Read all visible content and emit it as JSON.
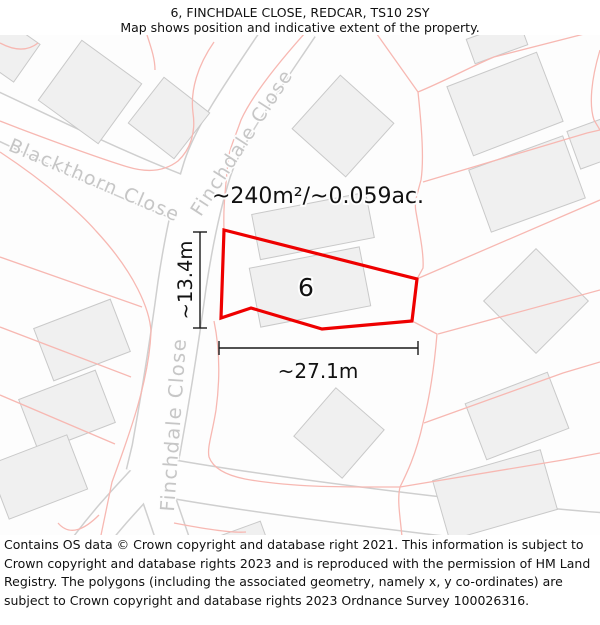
{
  "header": {
    "title": "6, FINCHDALE CLOSE, REDCAR, TS10 2SY",
    "subtitle": "Map shows position and indicative extent of the property."
  },
  "map": {
    "area_label": "~240m²/~0.059ac.",
    "plot_number": "6",
    "width_label": "~27.1m",
    "height_label": "~13.4m",
    "streets": {
      "blackthorn": "Blackthorn Close",
      "finchdale_upper": "Finchdale Close",
      "finchdale_lower": "Finchdale Close"
    },
    "colors": {
      "plot_outline": "#ee0000",
      "parcel_line": "#f7b8b2",
      "building_fill": "#f0f0f0",
      "building_stroke": "#c9c9c9",
      "road_edge": "#cfcfcf",
      "street_label": "#c6c6c6",
      "dimension": "#1a1a1a"
    }
  },
  "footer": {
    "attribution": "Contains OS data © Crown copyright and database right 2021. This information is subject to Crown copyright and database rights 2023 and is reproduced with the permission of HM Land Registry. The polygons (including the associated geometry, namely x, y co-ordinates) are subject to Crown copyright and database rights 2023 Ordnance Survey 100026316."
  }
}
